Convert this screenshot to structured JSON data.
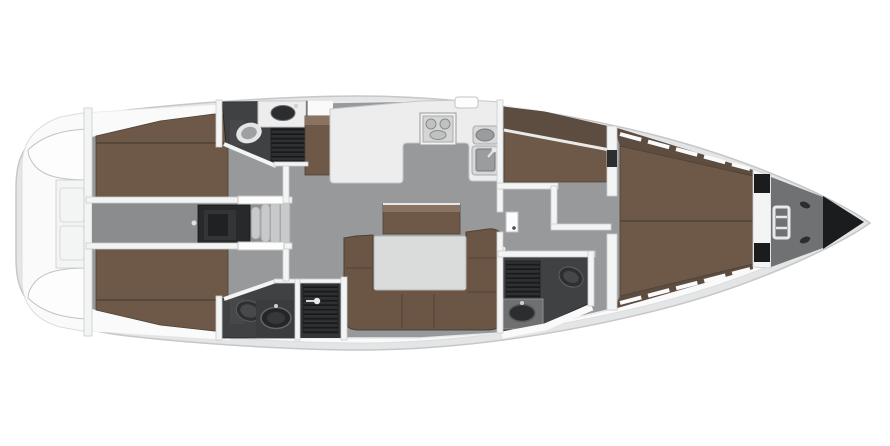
{
  "meta": {
    "type": "boat-interior-floorplan-top-view",
    "orientation": "bow-right-stern-left",
    "visible_text": "",
    "background": "#ffffff"
  },
  "colors": {
    "hull_rim": "#e4e5e6",
    "hull_stroke": "#c6c7c8",
    "deck": "#fafafa",
    "deck_line": "#dcddde",
    "floor": "#97999b",
    "floor_dark": "#8a8c8e",
    "wall": "#f3f4f4",
    "wall_stroke": "#cbccce",
    "bed": "#6e5847",
    "bed_dark": "#5d4c40",
    "bed_top": "#8a7360",
    "seam": "#4f4236",
    "sofa": "#6b5646",
    "sofa_edge": "#4e4034",
    "table": "#dadbdb",
    "head_floor": "#3f4143",
    "fixture_dark": "#2b2d2f",
    "porcelain": "#e4e5e5",
    "steel": "#9b9c9e",
    "counter": "#ededee",
    "counter_edge": "#c7c8c9",
    "step": "#c8c9ca",
    "black": "#1a1c1e",
    "engine": "#27292b",
    "forepeak": "#6f7173",
    "grate_base": "#2e3032",
    "grate_stripe": "#17191b"
  },
  "regions": [
    {
      "name": "hull"
    },
    {
      "name": "side-decks"
    },
    {
      "name": "stern-cockpit"
    },
    {
      "name": "aft-cabin-port"
    },
    {
      "name": "aft-head-port"
    },
    {
      "name": "companionway-steps"
    },
    {
      "name": "engine-compartment"
    },
    {
      "name": "aft-cabin-starboard"
    },
    {
      "name": "aft-head-starboard"
    },
    {
      "name": "galley"
    },
    {
      "name": "salon-u-sofa"
    },
    {
      "name": "dinette-table"
    },
    {
      "name": "forward-cabin-port"
    },
    {
      "name": "forward-head-starboard"
    },
    {
      "name": "owners-cabin-v-berth"
    },
    {
      "name": "forepeak-locker"
    },
    {
      "name": "anchor-chain-locker"
    }
  ]
}
